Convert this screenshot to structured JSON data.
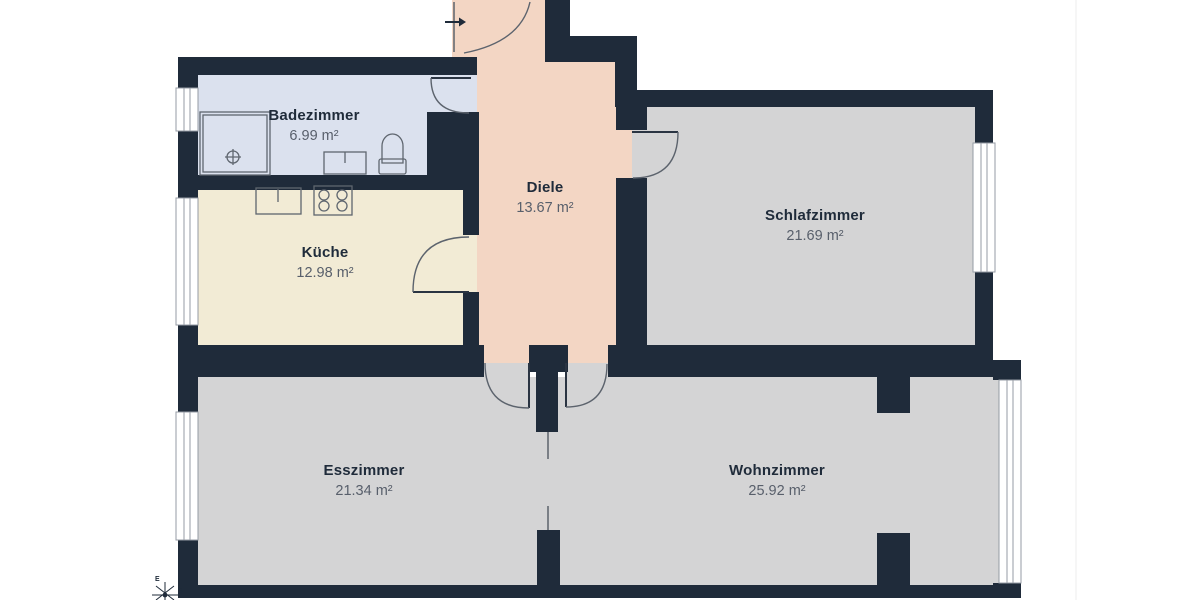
{
  "plan_title": "Wohnung Grundriss",
  "rooms": [
    {
      "id": "badezimmer",
      "name": "Badezimmer",
      "area": "6.99 m²"
    },
    {
      "id": "kueche",
      "name": "Küche",
      "area": "12.98 m²"
    },
    {
      "id": "diele",
      "name": "Diele",
      "area": "13.67 m²"
    },
    {
      "id": "schlafzimmer",
      "name": "Schlafzimmer",
      "area": "21.69 m²"
    },
    {
      "id": "esszimmer",
      "name": "Esszimmer",
      "area": "21.34 m²"
    },
    {
      "id": "wohnzimmer",
      "name": "Wohnzimmer",
      "area": "25.92 m²"
    }
  ],
  "compass": {
    "e": "E",
    "s": "S"
  },
  "colors": {
    "wall": "#1f2b3a",
    "bath": "#dbe1ee",
    "kitchen": "#f2ebd5",
    "hall": "#f3d6c4",
    "room": "#d4d4d5",
    "winline": "#959ba4",
    "leaf": "#2a3442",
    "arcline": "#5c636d",
    "fixline": "#5f666f",
    "label": "#1f2b3a",
    "sublabel": "#585f6b"
  }
}
